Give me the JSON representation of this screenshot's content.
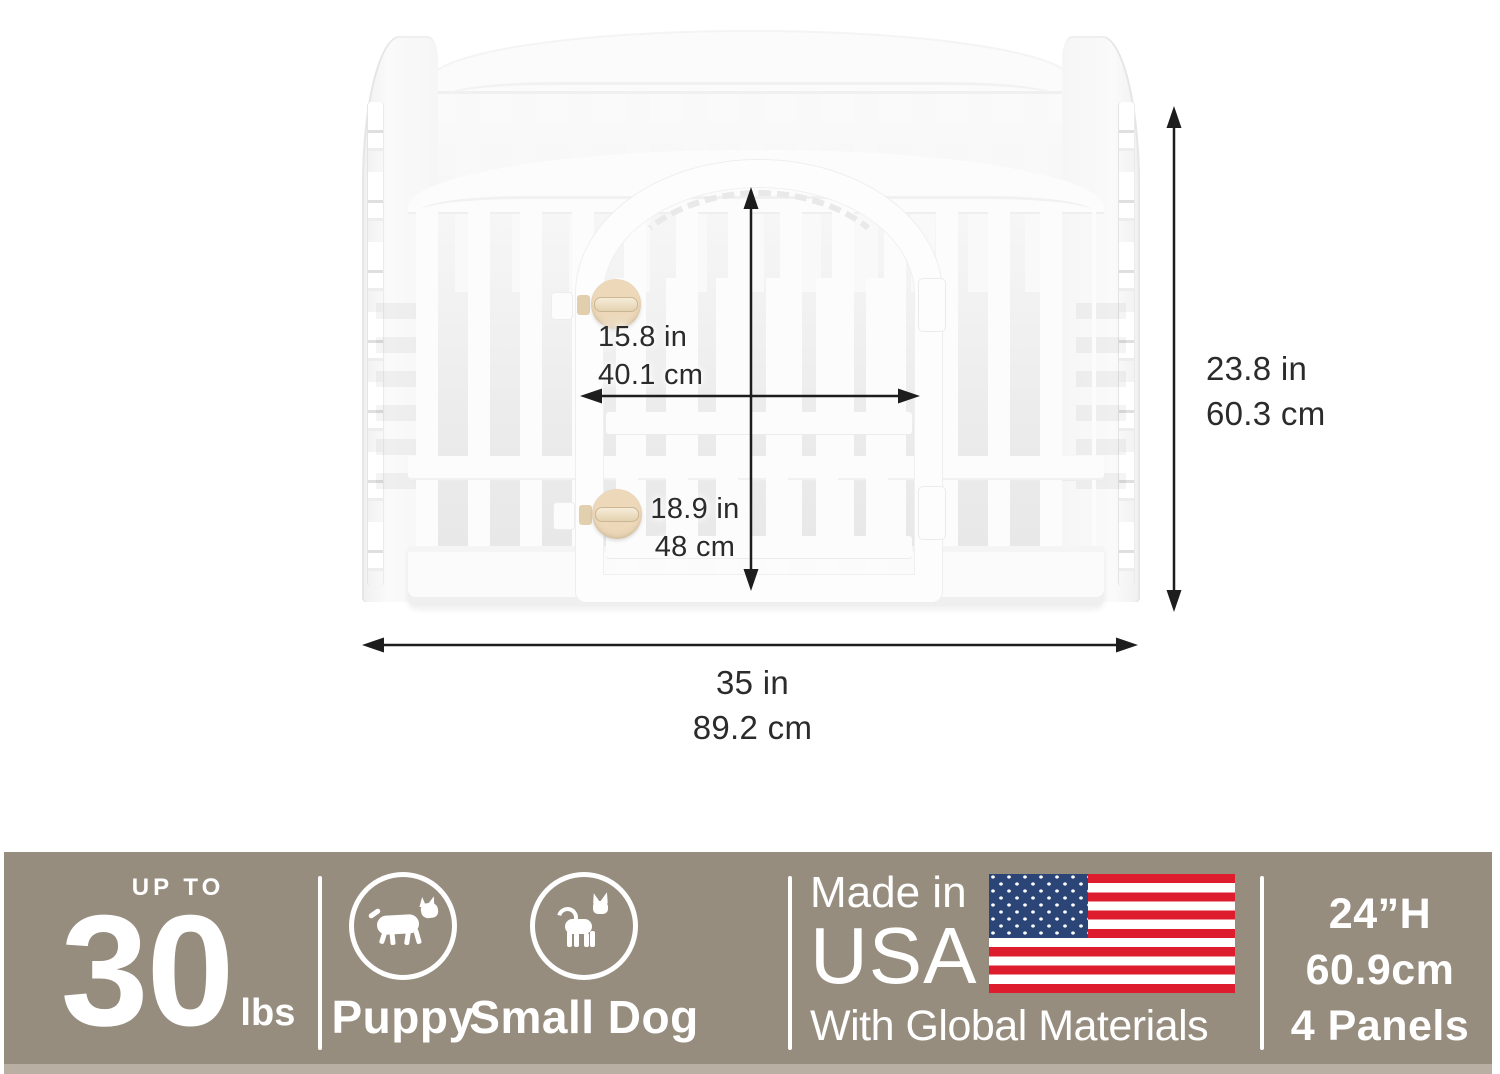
{
  "dimensions": {
    "door_width_in": "15.8 in",
    "door_width_cm": "40.1 cm",
    "door_height_in": "18.9 in",
    "door_height_cm": "48 cm",
    "pen_height_in": "23.8 in",
    "pen_height_cm": "60.3 cm",
    "pen_width_in": "35 in",
    "pen_width_cm": "89.2 cm"
  },
  "banner": {
    "weight": {
      "prefix": "UP TO",
      "value": "30",
      "unit": "lbs"
    },
    "pets": {
      "puppy_label": "Puppy",
      "small_dog_label": "Small Dog"
    },
    "origin": {
      "made_in": "Made in",
      "country": "USA",
      "materials": "With Global Materials"
    },
    "specs": {
      "height_in": "24”H",
      "height_cm": "60.9cm",
      "panels": "4 Panels"
    },
    "colors": {
      "background": "#978D7F",
      "text": "#FFFFFF",
      "flag_red": "#DD1C2E",
      "flag_blue": "#2B4577",
      "knob_tan": "#E2CFAE"
    }
  }
}
